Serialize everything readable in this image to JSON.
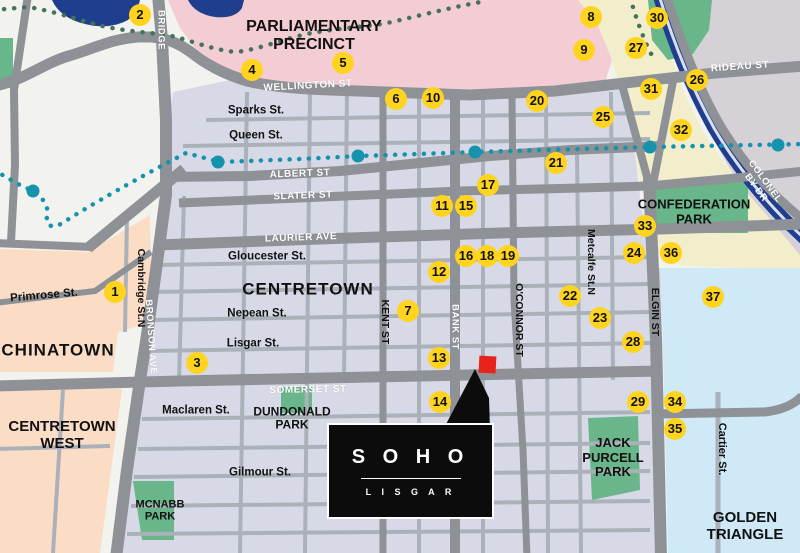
{
  "colors": {
    "background": "#f2f2ef",
    "city_block": "#d8d9e6",
    "major_road": "#8e9296",
    "minor_road": "#abb1b8",
    "parliamentary_precinct": "#f4ccd3",
    "chinatown_peach": "#fbdcc5",
    "cream_area": "#f2edca",
    "northeast_mauve": "#d6d0d7",
    "golden_triangle_blue": "#cfe9f6",
    "park_green": "#68b689",
    "water_navy": "#1f3e8e",
    "transit_teal": "#1593ad",
    "trail_green": "#44735c",
    "marker_yellow": "#ffd41e",
    "location_red": "#e7231b"
  },
  "soho": {
    "title": "S O H O",
    "subtitle": "L I S G A R"
  },
  "labels": [
    {
      "id": "parliamentary-precinct",
      "text": "PARLIAMENTARY\nPRECINCT",
      "x": 314,
      "y": 36,
      "style": "area",
      "size": 16
    },
    {
      "id": "centretown",
      "text": "CENTRETOWN",
      "x": 308,
      "y": 289,
      "style": "area",
      "size": 17,
      "ls": 1
    },
    {
      "id": "chinatown",
      "text": "CHINATOWN",
      "x": 58,
      "y": 350,
      "style": "area",
      "size": 17,
      "ls": 1
    },
    {
      "id": "centretown-west",
      "text": "CENTRETOWN\nWEST",
      "x": 62,
      "y": 436,
      "style": "area",
      "size": 15
    },
    {
      "id": "golden-triangle",
      "text": "GOLDEN\nTRIANGLE",
      "x": 745,
      "y": 527,
      "style": "area",
      "size": 15
    },
    {
      "id": "confederation-park",
      "text": "CONFEDERATION\nPARK",
      "x": 694,
      "y": 212,
      "style": "area",
      "size": 13
    },
    {
      "id": "jack-purcell-park",
      "text": "JACK\nPURCELL\nPARK",
      "x": 613,
      "y": 458,
      "style": "area",
      "size": 13
    },
    {
      "id": "dundonald-park",
      "text": "DUNDONALD\nPARK",
      "x": 292,
      "y": 419,
      "style": "area",
      "size": 12
    },
    {
      "id": "mcnabb-park",
      "text": "MCNABB\nPARK",
      "x": 160,
      "y": 511,
      "style": "area",
      "size": 11
    },
    {
      "id": "wellington-st",
      "text": "WELLINGTON ST",
      "x": 308,
      "y": 86,
      "style": "street-white",
      "size": 10,
      "rot": -3
    },
    {
      "id": "rideau-st",
      "text": "RIDEAU ST",
      "x": 740,
      "y": 67,
      "style": "street-white",
      "size": 10,
      "rot": -4
    },
    {
      "id": "albert-st",
      "text": "ALBERT ST",
      "x": 300,
      "y": 174,
      "style": "street-white",
      "size": 10,
      "rot": -2
    },
    {
      "id": "slater-st",
      "text": "SLATER ST",
      "x": 303,
      "y": 196,
      "style": "street-white",
      "size": 10,
      "rot": -2
    },
    {
      "id": "laurier-ave",
      "text": "LAURIER AVE",
      "x": 301,
      "y": 238,
      "style": "street-white",
      "size": 10,
      "rot": -2
    },
    {
      "id": "somerset-st",
      "text": "SOMERSET ST",
      "x": 308,
      "y": 390,
      "style": "street-white",
      "size": 10,
      "rot": -1
    },
    {
      "id": "bridge",
      "text": "BRIDGE",
      "x": 160,
      "y": 30,
      "style": "street-white",
      "size": 9.5,
      "rot": 90
    },
    {
      "id": "bronson-ave",
      "text": "BRONSON AVE",
      "x": 150,
      "y": 337,
      "style": "street-white",
      "size": 9.5,
      "rot": 86
    },
    {
      "id": "bank-st",
      "text": "BANK ST",
      "x": 454,
      "y": 327,
      "style": "street-white",
      "size": 9.5,
      "rot": 90
    },
    {
      "id": "colonel-by-dr",
      "text": "COLONEL BY DR",
      "x": 760,
      "y": 185,
      "style": "street-white",
      "size": 9.5,
      "rot": 54
    },
    {
      "id": "sparks-st",
      "text": "Sparks St.",
      "x": 256,
      "y": 111,
      "style": "street-black",
      "size": 11.5
    },
    {
      "id": "queen-st",
      "text": "Queen St.",
      "x": 256,
      "y": 136,
      "style": "street-black",
      "size": 11.5
    },
    {
      "id": "gloucester-st",
      "text": "Gloucester St.",
      "x": 267,
      "y": 257,
      "style": "street-black",
      "size": 11.5
    },
    {
      "id": "nepean-st",
      "text": "Nepean St.",
      "x": 257,
      "y": 314,
      "style": "street-black",
      "size": 11.5
    },
    {
      "id": "lisgar-st",
      "text": "Lisgar St.",
      "x": 253,
      "y": 344,
      "style": "street-black",
      "size": 11.5
    },
    {
      "id": "primrose-st",
      "text": "Primrose St.",
      "x": 44,
      "y": 296,
      "style": "street-black",
      "size": 11.5,
      "rot": -5
    },
    {
      "id": "maclaren-st",
      "text": "Maclaren St.",
      "x": 196,
      "y": 411,
      "style": "street-black",
      "size": 11.5
    },
    {
      "id": "gilmour-st",
      "text": "Gilmour St.",
      "x": 260,
      "y": 473,
      "style": "street-black",
      "size": 11.5
    },
    {
      "id": "cartier-st",
      "text": "Cartier St.",
      "x": 722,
      "y": 449,
      "style": "street-black",
      "size": 11,
      "rot": 90
    },
    {
      "id": "kent-st",
      "text": "KENT ST",
      "x": 384,
      "y": 322,
      "style": "street-black",
      "size": 10.5,
      "rot": 90
    },
    {
      "id": "oconnor-st",
      "text": "O'CONNOR ST",
      "x": 518,
      "y": 320,
      "style": "street-black",
      "size": 10.5,
      "rot": 90
    },
    {
      "id": "metcalfe-st",
      "text": "Metcalfe St.N",
      "x": 590,
      "y": 262,
      "style": "street-black",
      "size": 10.5,
      "rot": 90
    },
    {
      "id": "cambridge-st",
      "text": "Cambridge St.N",
      "x": 140,
      "y": 288,
      "style": "street-black",
      "size": 10.5,
      "rot": 90
    },
    {
      "id": "elgin-st",
      "text": "ELGIN ST",
      "x": 654,
      "y": 312,
      "style": "street-black",
      "size": 10.5,
      "rot": 90
    }
  ],
  "markers": [
    {
      "n": "1",
      "x": 115,
      "y": 292
    },
    {
      "n": "2",
      "x": 140,
      "y": 15
    },
    {
      "n": "3",
      "x": 197,
      "y": 363
    },
    {
      "n": "4",
      "x": 252,
      "y": 70
    },
    {
      "n": "5",
      "x": 343,
      "y": 63
    },
    {
      "n": "6",
      "x": 396,
      "y": 99
    },
    {
      "n": "7",
      "x": 408,
      "y": 311
    },
    {
      "n": "8",
      "x": 591,
      "y": 17
    },
    {
      "n": "9",
      "x": 584,
      "y": 50
    },
    {
      "n": "10",
      "x": 433,
      "y": 98
    },
    {
      "n": "11",
      "x": 442,
      "y": 206
    },
    {
      "n": "12",
      "x": 439,
      "y": 272
    },
    {
      "n": "13",
      "x": 439,
      "y": 358
    },
    {
      "n": "14",
      "x": 440,
      "y": 402
    },
    {
      "n": "15",
      "x": 466,
      "y": 206
    },
    {
      "n": "16",
      "x": 466,
      "y": 256
    },
    {
      "n": "17",
      "x": 488,
      "y": 185
    },
    {
      "n": "18",
      "x": 487,
      "y": 256
    },
    {
      "n": "19",
      "x": 508,
      "y": 256
    },
    {
      "n": "20",
      "x": 537,
      "y": 101
    },
    {
      "n": "21",
      "x": 556,
      "y": 163
    },
    {
      "n": "22",
      "x": 570,
      "y": 296
    },
    {
      "n": "23",
      "x": 600,
      "y": 318
    },
    {
      "n": "24",
      "x": 634,
      "y": 253
    },
    {
      "n": "25",
      "x": 603,
      "y": 117
    },
    {
      "n": "26",
      "x": 697,
      "y": 80
    },
    {
      "n": "27",
      "x": 636,
      "y": 48
    },
    {
      "n": "28",
      "x": 633,
      "y": 342
    },
    {
      "n": "29",
      "x": 638,
      "y": 402
    },
    {
      "n": "30",
      "x": 657,
      "y": 18
    },
    {
      "n": "31",
      "x": 651,
      "y": 89
    },
    {
      "n": "32",
      "x": 681,
      "y": 130
    },
    {
      "n": "33",
      "x": 645,
      "y": 226
    },
    {
      "n": "34",
      "x": 675,
      "y": 402
    },
    {
      "n": "35",
      "x": 675,
      "y": 429
    },
    {
      "n": "36",
      "x": 671,
      "y": 253
    },
    {
      "n": "37",
      "x": 713,
      "y": 297
    }
  ]
}
